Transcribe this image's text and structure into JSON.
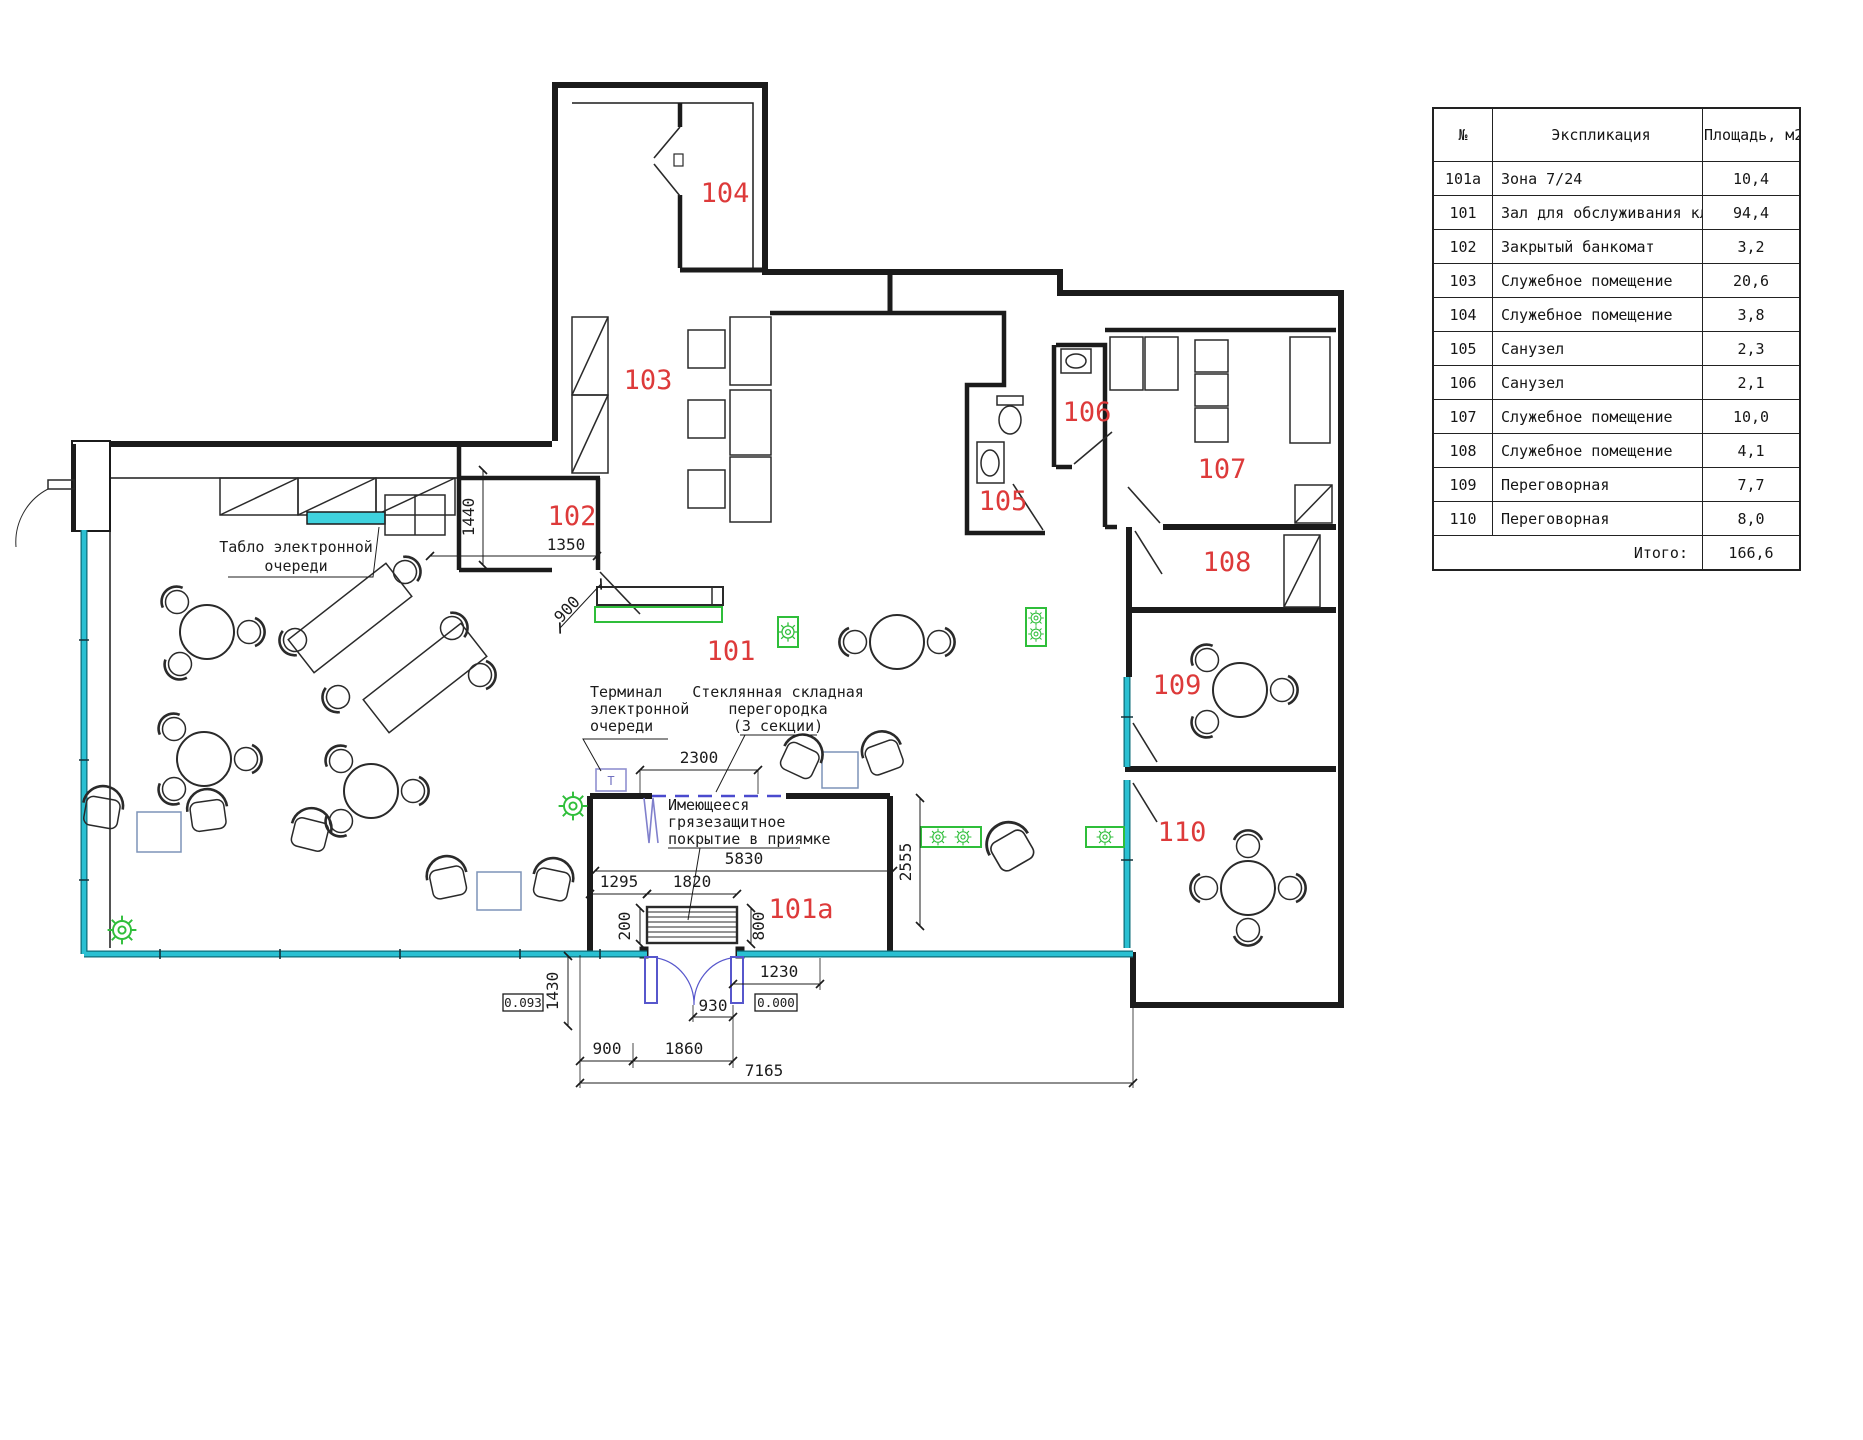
{
  "drawing": {
    "type": "bank-branch-floor-plan",
    "colors": {
      "wall": "#1b1b1b",
      "room_label_red": "#dd3a3a",
      "glass_cyan": "#2ac0d2",
      "tablo_fill": "#3fd2de",
      "plant_green": "#2fbe3a",
      "bench_green": "#2fbe3a",
      "door_blue": "#5757cc",
      "partition_dash_blue": "#4a4ace",
      "furniture_accent_blue": "#7d93b8",
      "terminal_box_purple": "#9090d0"
    },
    "room_labels": {
      "r101a": "101а",
      "r101": "101",
      "r102": "102",
      "r103": "103",
      "r104": "104",
      "r105": "105",
      "r106": "106",
      "r107": "107",
      "r108": "108",
      "r109": "109",
      "r110": "110"
    },
    "dimensions": {
      "h1440": "1440",
      "w1350": "1350",
      "door900": "900",
      "w2300": "2300",
      "w5830": "5830",
      "w1295": "1295",
      "w1820": "1820",
      "h200": "200",
      "h800": "800",
      "h2555": "2555",
      "w1230": "1230",
      "w930": "930",
      "h1430": "1430",
      "w900": "900",
      "w1860": "1860",
      "w7165": "7165"
    },
    "elevations": {
      "outside": "0.093",
      "inside": "0.000"
    },
    "annotations": {
      "tablo": {
        "line1": "Табло электронной",
        "line2": "очереди"
      },
      "terminal": {
        "line1": "Терминал",
        "line2": "электронной",
        "line3": "очереди",
        "symbol": "T"
      },
      "partition": {
        "line1": "Стеклянная складная",
        "line2": "перегородка",
        "line3": "(3 секции)"
      },
      "mat": {
        "line1": "Имеющееся",
        "line2": "грязезащитное",
        "line3": "покрытие в приямке"
      }
    }
  },
  "legend": {
    "headers": {
      "no": "№",
      "name": "Экспликация",
      "area": "Площадь, м2"
    },
    "rows": [
      {
        "no": "101а",
        "name": "Зона 7/24",
        "area": "10,4"
      },
      {
        "no": "101",
        "name": "Зал для обслуживания клиентов",
        "area": "94,4"
      },
      {
        "no": "102",
        "name": "Закрытый банкомат",
        "area": "3,2"
      },
      {
        "no": "103",
        "name": "Служебное помещение",
        "area": "20,6"
      },
      {
        "no": "104",
        "name": "Служебное помещение",
        "area": "3,8"
      },
      {
        "no": "105",
        "name": "Санузел",
        "area": "2,3"
      },
      {
        "no": "106",
        "name": "Санузел",
        "area": "2,1"
      },
      {
        "no": "107",
        "name": "Служебное помещение",
        "area": "10,0"
      },
      {
        "no": "108",
        "name": "Служебное помещение",
        "area": "4,1"
      },
      {
        "no": "109",
        "name": "Переговорная",
        "area": "7,7"
      },
      {
        "no": "110",
        "name": "Переговорная",
        "area": "8,0"
      }
    ],
    "total_label": "Итого:",
    "total_value": "166,6"
  }
}
